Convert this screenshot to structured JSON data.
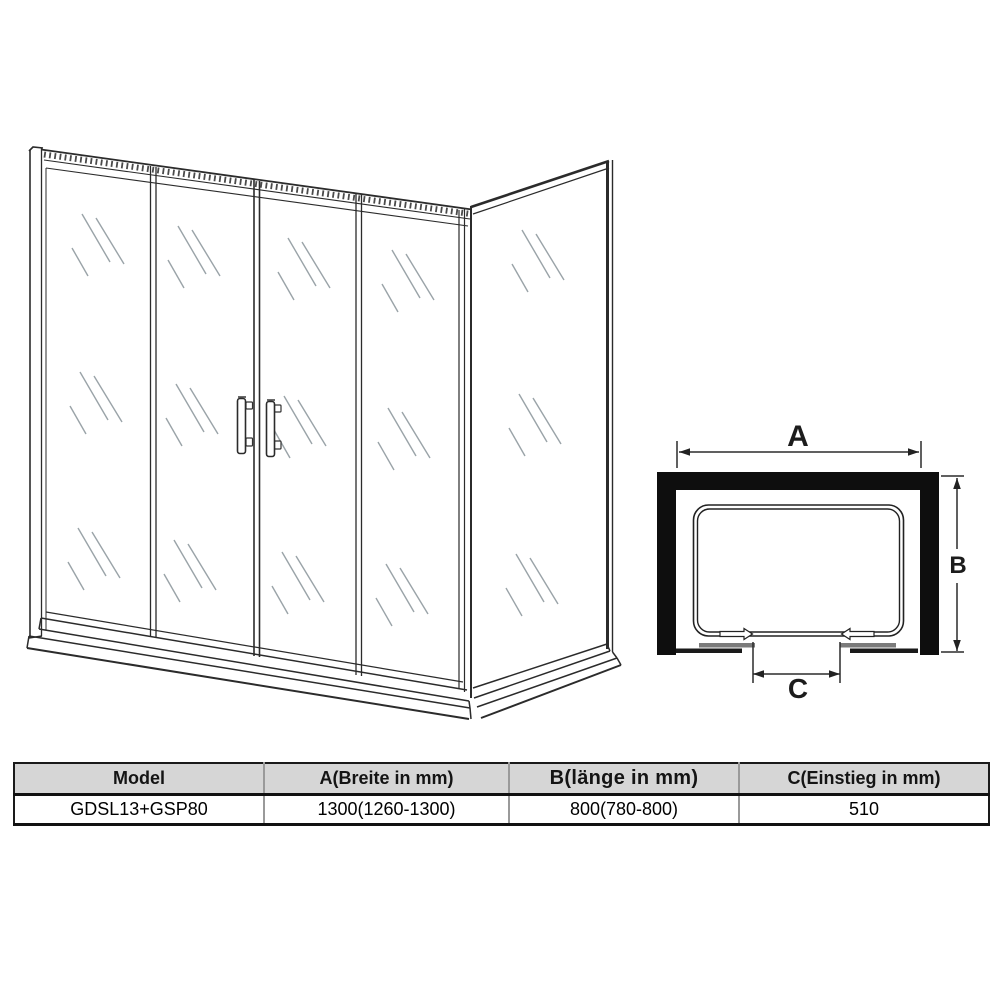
{
  "top_view": {
    "label_a": "A",
    "label_b": "B",
    "label_c": "C"
  },
  "spec_table": {
    "headers": [
      "Model",
      "A(Breite in mm)",
      "B(länge in mm)",
      "C(Einstieg in mm)"
    ],
    "rows": [
      [
        "GDSL13+GSP80",
        "1300(1260-1300)",
        "800(780-800)",
        "510"
      ]
    ]
  },
  "colors": {
    "frame_black": "#0e0e0e",
    "line_dark": "#2b2b2b",
    "glass_mark_gray": "#9aa3a8",
    "table_header_bg": "#d6d6d6",
    "track_gray": "#7b7b7b"
  }
}
